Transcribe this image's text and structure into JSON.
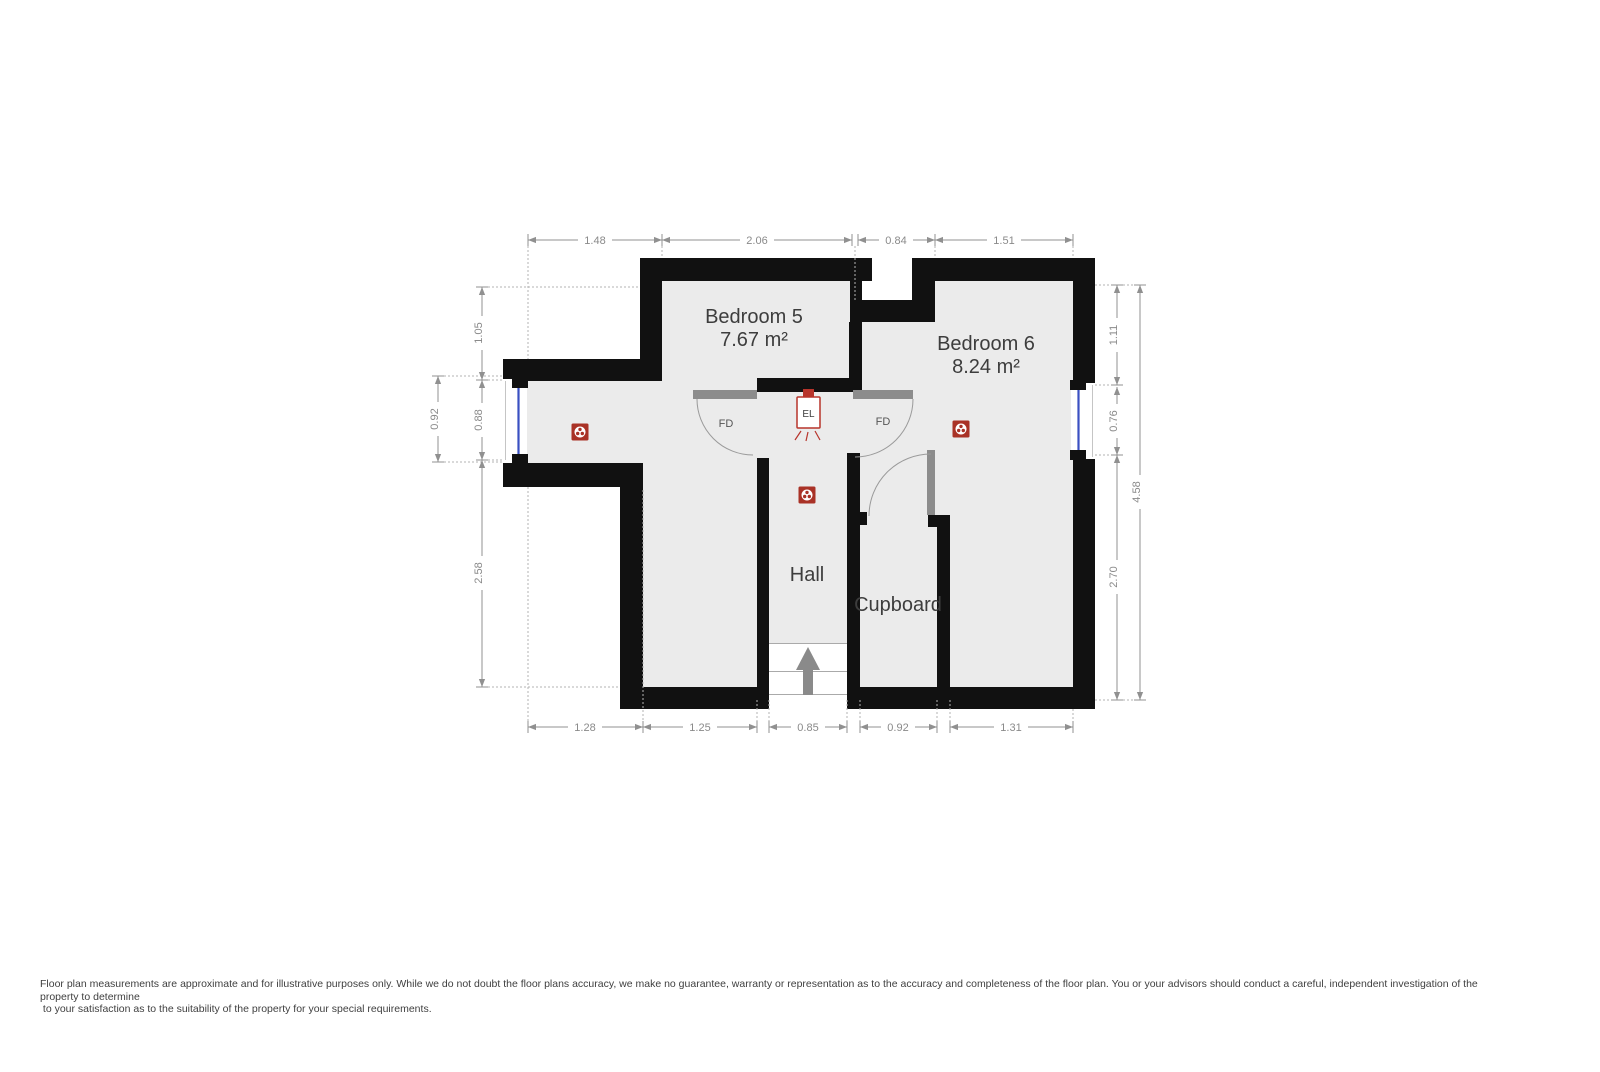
{
  "floorplan": {
    "rooms": {
      "bedroom5": {
        "name": "Bedroom 5",
        "area": "7.67 m²"
      },
      "bedroom6": {
        "name": "Bedroom 6",
        "area": "8.24 m²"
      },
      "hall": {
        "name": "Hall"
      },
      "cupboard": {
        "name": "Cupboard"
      }
    },
    "door_labels": {
      "left": "FD",
      "right": "FD"
    },
    "electrical_label": "EL",
    "dimensions": {
      "top": [
        "1.48",
        "2.06",
        "0.84",
        "1.51"
      ],
      "left_outer": [
        "0.92"
      ],
      "left_inner": [
        "1.05",
        "0.88",
        "2.58"
      ],
      "right_inner": [
        "1.11",
        "0.76",
        "2.70"
      ],
      "right_outer": [
        "4.58"
      ],
      "bottom": [
        "1.28",
        "1.25",
        "0.85",
        "0.92",
        "1.31"
      ]
    },
    "colors": {
      "wall": "#111111",
      "floor": "#ebebeb",
      "door_bar": "#8c8c8c",
      "window_glass": "#3a50c2",
      "detector_red": "#a93226",
      "el_red": "#b7342b",
      "dim_gray": "#909090",
      "label_gray": "#3d3d3d",
      "stairs_arrow": "#8a8a8a"
    }
  },
  "disclaimer": {
    "line1": "Floor plan measurements are approximate and for illustrative purposes only. While we do not doubt the floor plans accuracy, we make no guarantee, warranty or representation as to the accuracy and completeness of the floor plan. You or your advisors should conduct a careful, independent investigation of the",
    "line2": "property to determine",
    "line3": " to your satisfaction as to the suitability of the property for your special requirements."
  }
}
